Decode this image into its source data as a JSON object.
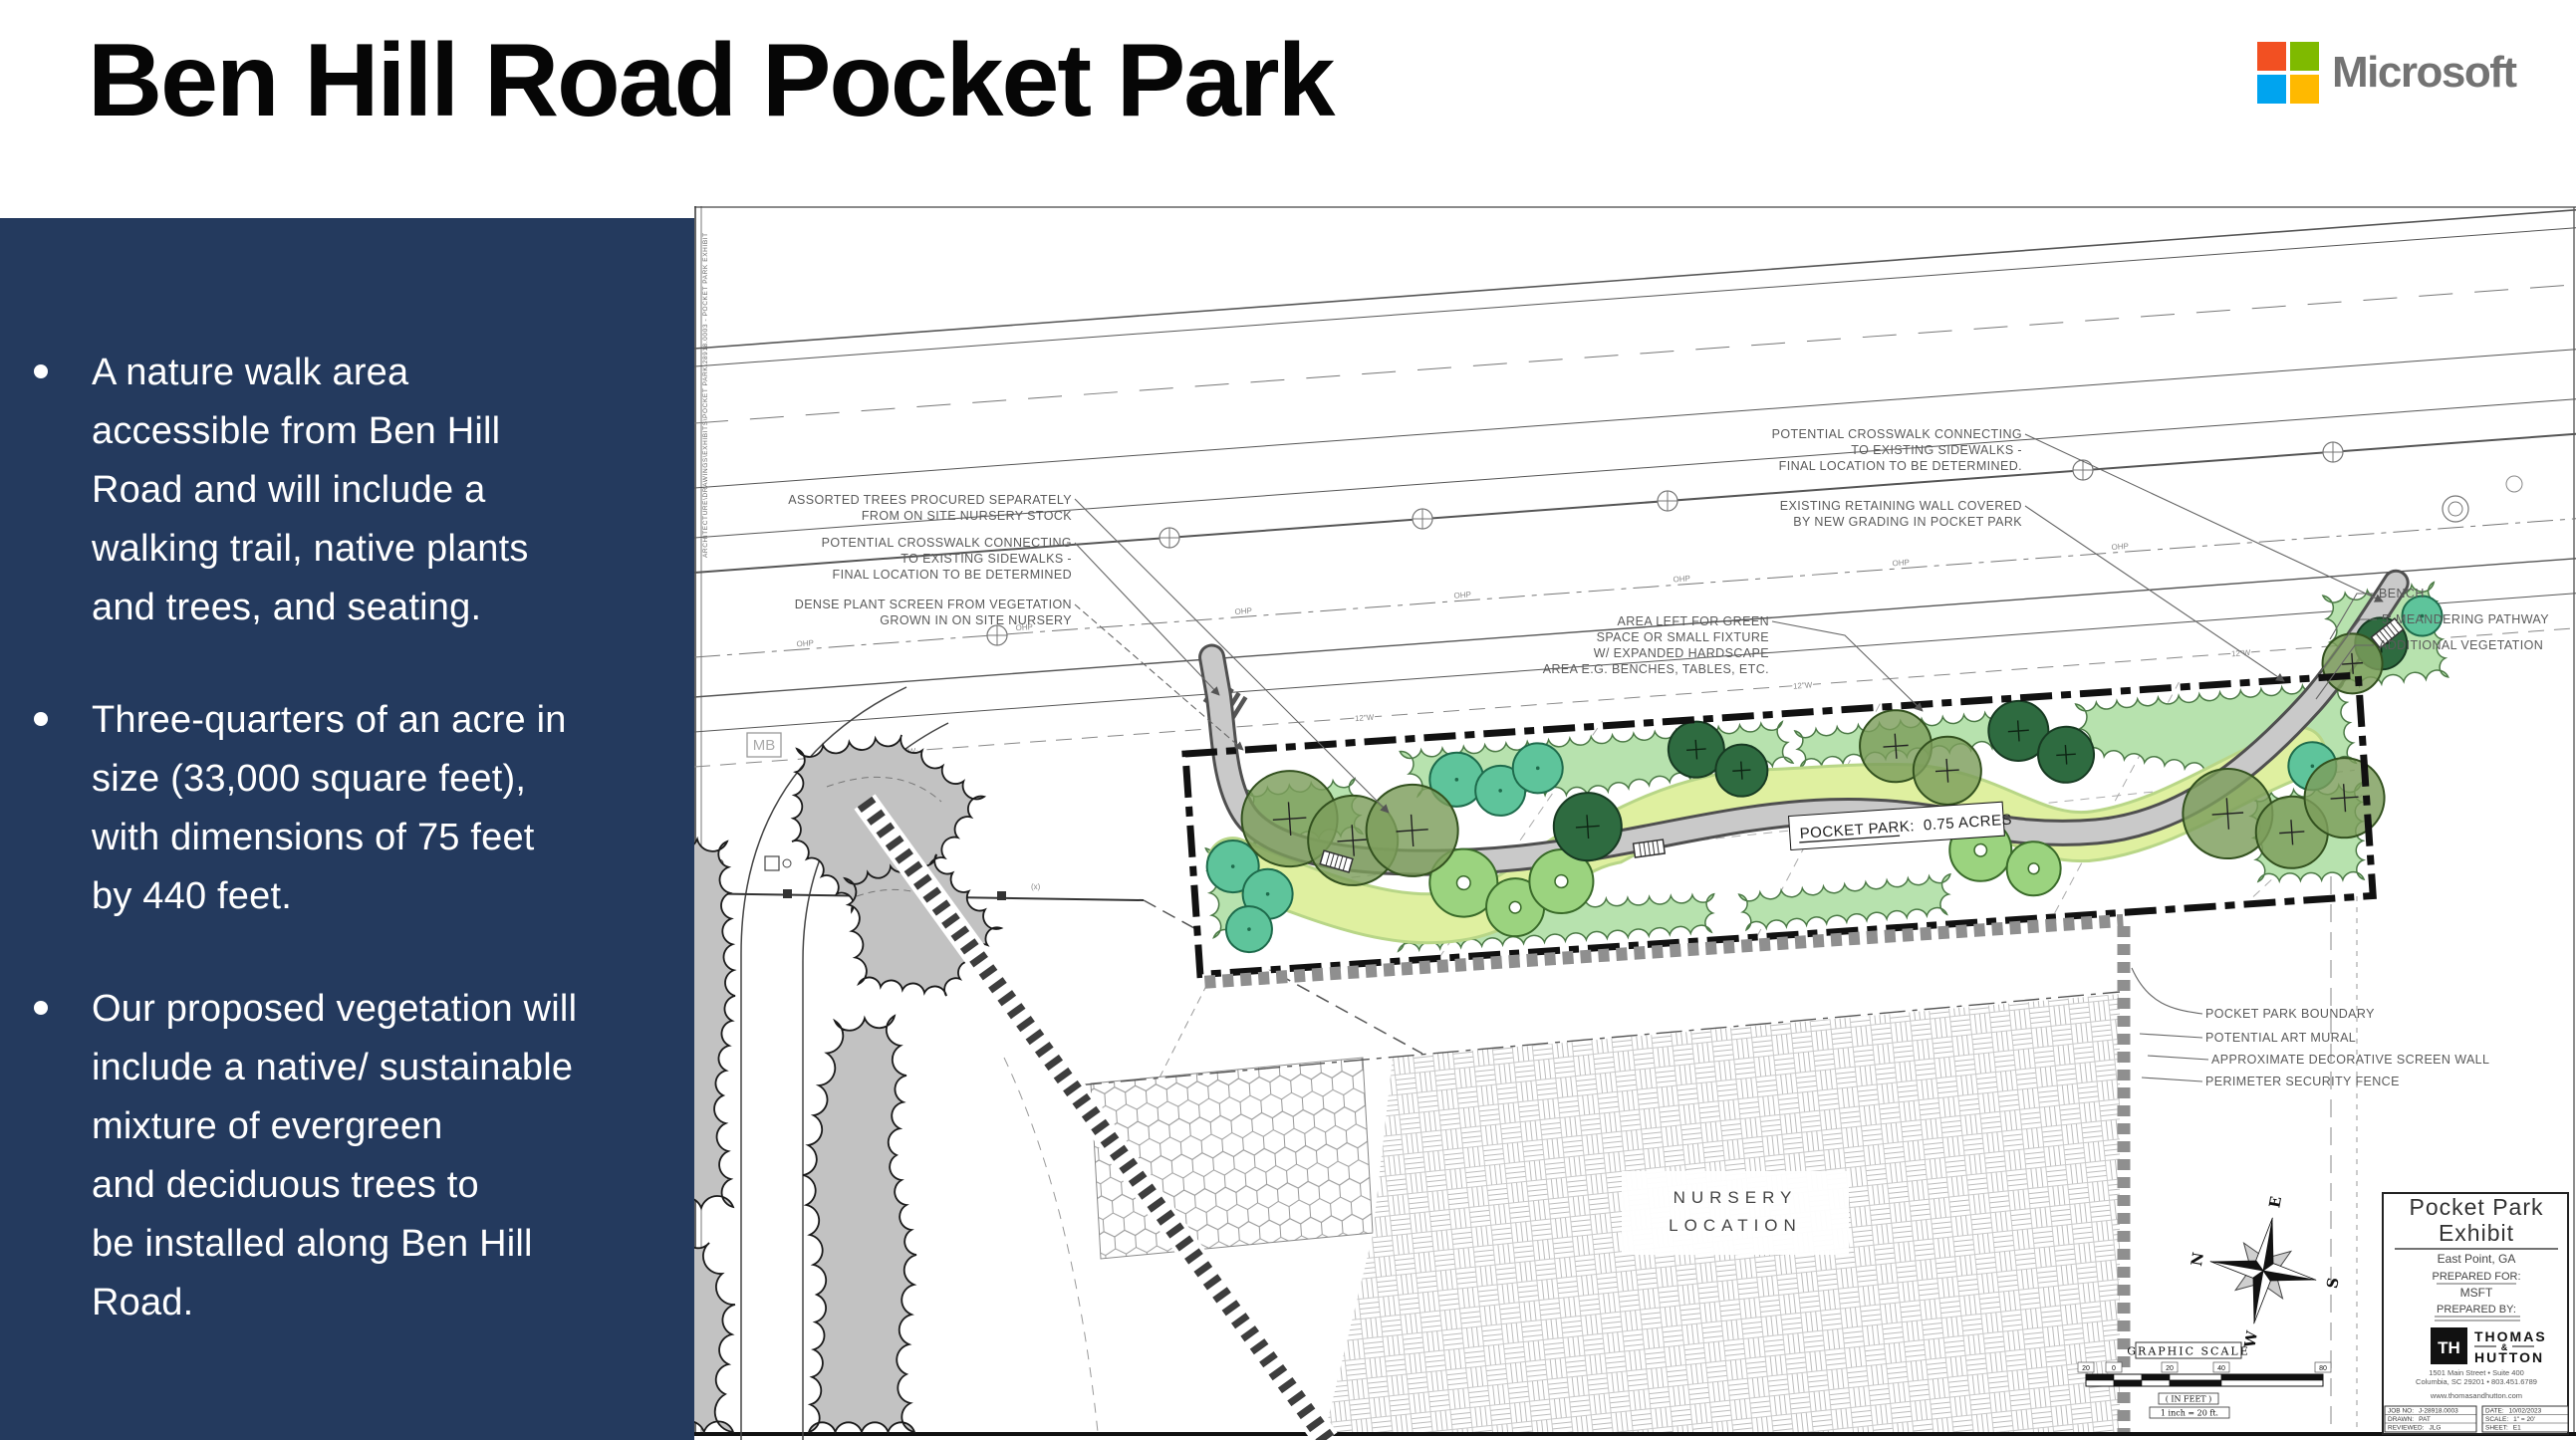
{
  "slide": {
    "title": "Ben Hill Road Pocket Park",
    "logo": {
      "name": "Microsoft",
      "colors": {
        "red": "#F25022",
        "green": "#7FBA00",
        "blue": "#00A4EF",
        "yellow": "#FFB900"
      },
      "text_color": "#737373"
    },
    "sidebar": {
      "bg": "#243A5E",
      "bullets": [
        "A nature walk area\naccessible from Ben Hill\nRoad and will include a\nwalking trail, native plants\nand trees, and seating.",
        "Three-quarters of an acre in\nsize (33,000 square feet),\nwith dimensions of 75 feet\nby 440 feet.",
        "Our proposed vegetation will\ninclude a native/ sustainable\nmixture of evergreen\nand deciduous trees to\nbe installed along Ben Hill\nRoad."
      ]
    }
  },
  "plan": {
    "edge_text": "ARCHITECTURE\\DRAWINGS\\EXHIBITS\\POCKET PARK\\28918.0003 - POCKET PARK EXHIBIT",
    "callouts": {
      "assorted": [
        "ASSORTED TREES PROCURED SEPARATELY",
        "FROM ON SITE NURSERY STOCK"
      ],
      "crosswalk_left": [
        "POTENTIAL CROSSWALK CONNECTING",
        "TO EXISTING SIDEWALKS -",
        "FINAL LOCATION TO BE DETERMINED"
      ],
      "dense": [
        "DENSE PLANT SCREEN FROM VEGETATION",
        "GROWN IN ON SITE NURSERY"
      ],
      "area_left": [
        "AREA LEFT FOR GREEN",
        "SPACE OR SMALL FIXTURE",
        "W/ EXPANDED HARDSCAPE",
        "AREA E.G. BENCHES, TABLES, ETC."
      ],
      "crosswalk_right": [
        "POTENTIAL CROSSWALK CONNECTING",
        "TO EXISTING SIDEWALKS -",
        "FINAL LOCATION TO BE DETERMINED."
      ],
      "retaining": [
        "EXISTING RETAINING WALL COVERED",
        "BY NEW GRADING IN POCKET PARK"
      ],
      "bench": "BENCH",
      "pathway": "5' MEANDERING PATHWAY",
      "additional_veg": "ADDITIONAL VEGETATION",
      "boundary": "POCKET PARK BOUNDARY",
      "art_mural": "POTENTIAL ART MURAL",
      "screen_wall": "APPROXIMATE DECORATIVE SCREEN WALL",
      "security_fence": "PERIMETER SECURITY FENCE"
    },
    "labels": {
      "pocket_park_title": "POCKET PARK:",
      "pocket_park_acres": "0.75 ACRES",
      "nursery_1": "NURSERY",
      "nursery_2": "LOCATION",
      "mb": "MB",
      "ohp": "OHP",
      "water": "12\"W",
      "x_marker": "(x)"
    },
    "compass": {
      "n": "N",
      "e": "E",
      "s": "S",
      "w": "W"
    },
    "scale": {
      "title": "GRAPHIC SCALE",
      "ticks": [
        "20",
        "0",
        "20",
        "40",
        "80"
      ],
      "in_feet": "( IN FEET )",
      "ratio": "1 inch = 20 ft."
    },
    "titleblock": {
      "title_1": "Pocket Park",
      "title_2": "Exhibit",
      "location": "East Point, GA",
      "prepared_for_label": "PREPARED FOR:",
      "prepared_for": "MSFT",
      "prepared_by_label": "PREPARED BY:",
      "firm_monogram": "TH",
      "firm_1": "THOMAS",
      "firm_amp": "&",
      "firm_2": "HUTTON",
      "address1": "1501 Main Street  •  Suite 400",
      "address2": "Columbia, SC 29201  •  803.451.6789",
      "website": "www.thomasandhutton.com",
      "job_no_label": "JOB NO:",
      "job_no": "J-28918.0003",
      "drawn_label": "DRAWN:",
      "drawn": "PAT",
      "reviewed_label": "REVIEWED:",
      "reviewed": "JLG",
      "date_label": "DATE:",
      "date": "10/02/2023",
      "scale_label": "SCALE:",
      "scale": "1\" = 20'",
      "sheet_label": "SHEET:",
      "sheet": "E1"
    }
  }
}
